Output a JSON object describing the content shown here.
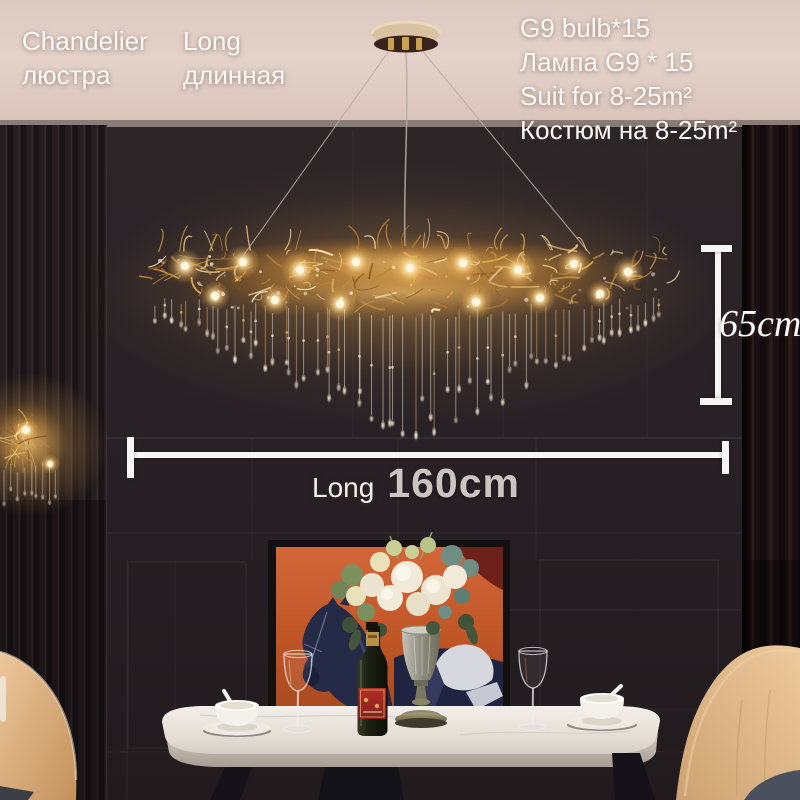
{
  "overlay": {
    "product": {
      "en": "Chandelier",
      "ru": "люстра"
    },
    "variant": {
      "en": "Long",
      "ru": "длинная"
    },
    "specs": [
      "G9 bulb*15",
      "Лампа G9 * 15",
      "Suit for 8-25m²",
      "Костюм на 8-25m²"
    ],
    "dim_height": "65cm",
    "dim_length_label": "Long",
    "dim_length_value": "160cm"
  },
  "scene": {
    "objects": [
      "gold-branch-chandelier",
      "ceiling-canopy",
      "wall-sconce",
      "slat-wall",
      "curtain",
      "horse-painting",
      "flower-bouquet",
      "trophy-vase",
      "wine-bottle",
      "wine-glasses",
      "coffee-cups",
      "marble-dining-table",
      "wooden-chairs"
    ]
  },
  "colors": {
    "gold_accent": "#d9a84e",
    "ceiling": "#e0cdc5",
    "wall": "#282125",
    "curtain": "#1d1214",
    "table_marble": "#ece7e0",
    "chair_wood": "#d8ad7b",
    "painting_orange": "#c65a2b",
    "dimension_line": "#f5f5f3",
    "text": "#faf8f5"
  }
}
